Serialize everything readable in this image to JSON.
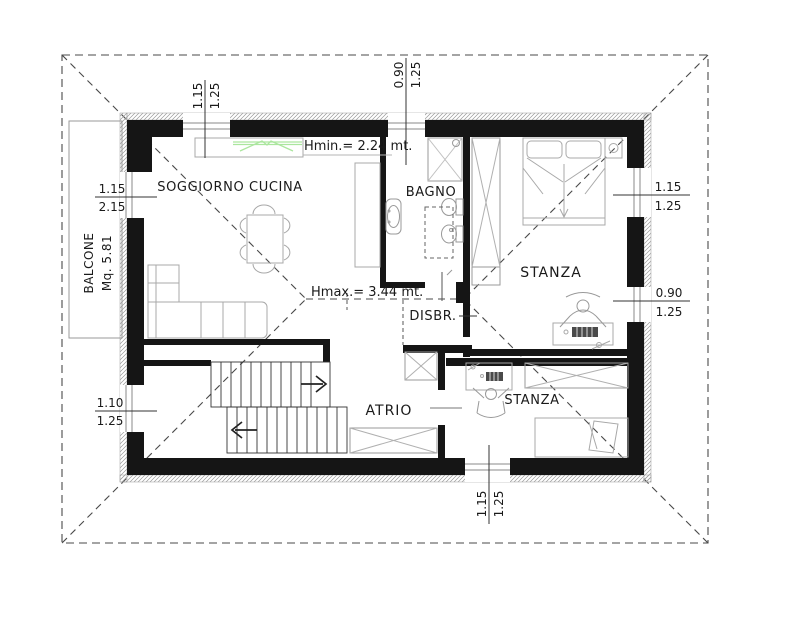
{
  "plan": {
    "rooms": {
      "soggiorno": "SOGGIORNO CUCINA",
      "bagno": "BAGNO",
      "stanza_nord": "STANZA",
      "disbr": "DISBR.",
      "atrio": "ATRIO",
      "stanza_sud": "STANZA",
      "balcone": "BALCONE",
      "balcone_area": "Mq. 5.81"
    },
    "annotations": {
      "hmin": "Hmin.= 2.24 mt.",
      "hmax": "Hmax.= 3.44 mt."
    },
    "dimensions": {
      "top_soggiorno_w": "1.15",
      "top_soggiorno_h": "1.25",
      "top_bagno_w": "0.90",
      "top_bagno_h": "1.25",
      "balcony_door_w": "1.15",
      "balcony_door_h": "2.15",
      "left_atrio_w": "1.10",
      "left_atrio_h": "1.25",
      "right_stanza1_w": "1.15",
      "right_stanza1_h": "1.25",
      "right_stanza2_w": "0.90",
      "right_stanza2_h": "1.25",
      "bottom_stanza_w": "1.15",
      "bottom_stanza_h": "1.25"
    },
    "colors": {
      "wall": "#151515",
      "kitchen_accent": "#abe69e",
      "furniture_line": "#a8a8a8",
      "roof_line": "#4a4a4a",
      "background": "#ffffff"
    }
  }
}
